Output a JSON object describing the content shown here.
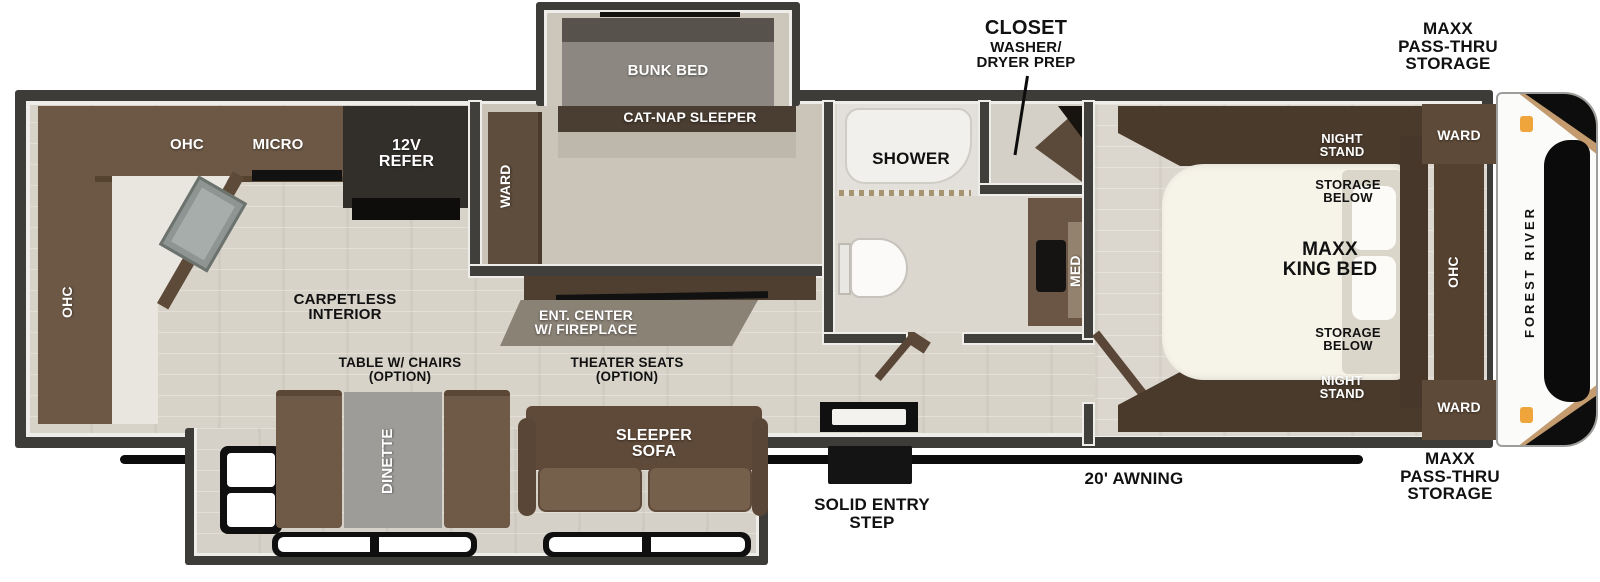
{
  "labels": {
    "ohc_top": "OHC",
    "micro": "MICRO",
    "refer": "12V\nREFER",
    "ohc_left": "OHC",
    "carpetless": "CARPETLESS\nINTERIOR",
    "ward_bunk": "WARD",
    "bunk_bed": "BUNK BED",
    "cat_nap": "CAT-NAP SLEEPER",
    "shower": "SHOWER",
    "med": "MED",
    "closet_title": "CLOSET",
    "closet_sub": "WASHER/\nDRYER PREP",
    "ent_center": "ENT. CENTER\nW/ FIREPLACE",
    "table_option": "TABLE W/ CHAIRS\n(OPTION)",
    "dinette": "DINETTE",
    "theater_option": "THEATER SEATS\n(OPTION)",
    "sleeper_sofa": "SLEEPER\nSOFA",
    "solid_entry": "SOLID ENTRY\nSTEP",
    "awning": "20' AWNING",
    "night_stand": "NIGHT\nSTAND",
    "storage_below": "STORAGE\nBELOW",
    "king_bed": "MAXX\nKING BED",
    "ward": "WARD",
    "ohc_bedroom": "OHC",
    "pass_thru": "MAXX\nPASS-THRU\nSTORAGE",
    "brand": "FOREST RIVER"
  },
  "colors": {
    "wall": "#3d3c39",
    "floor": "#d8d3c9",
    "cabinet": "#6d5846",
    "cabinet_dark": "#4a3a2c",
    "bed_white": "#f6f3e8",
    "table_gray": "#9d9c99",
    "marker_light": "#f0a53c",
    "awning_black": "#0c0c0c"
  }
}
